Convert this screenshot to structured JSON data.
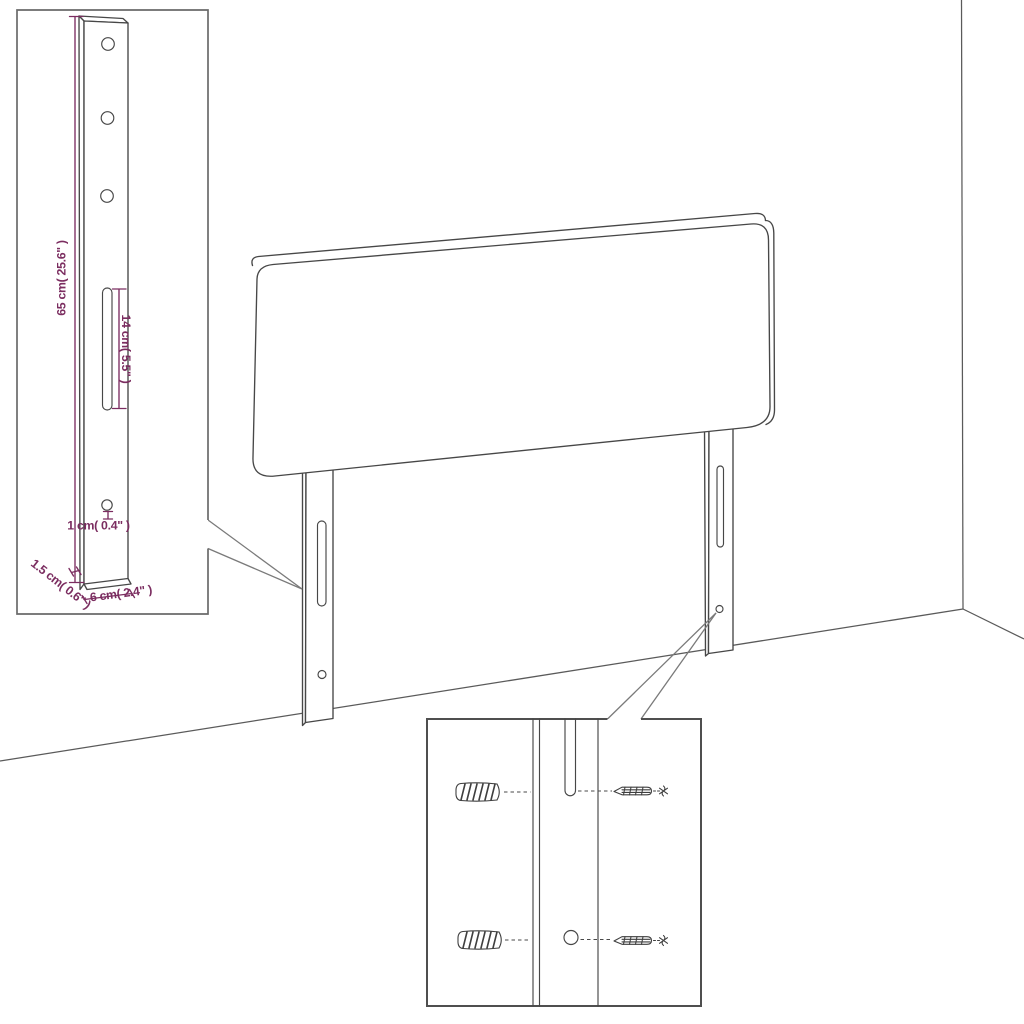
{
  "diagram": {
    "kind": "product-dimension-diagram",
    "subject": "upholstered headboard with two slotted mounting legs, room corner backdrop, two detail insets"
  },
  "dimensions": {
    "leg_height": "65 cm( 25.6\" )",
    "slot_length": "14 cm( 5.5\" )",
    "hole_size": "1 cm( 0.4\" )",
    "leg_thickness": "1.5 cm( 0.6\" )",
    "leg_width": "6 cm( 2.4\" )"
  },
  "icons": {
    "wall_plug": "wall-plug-icon",
    "screw": "screw-icon"
  },
  "colors": {
    "dimension_text": "#7b2d60",
    "outline": "#474747",
    "inset_border": "#6a6a6a",
    "background": "#ffffff"
  }
}
